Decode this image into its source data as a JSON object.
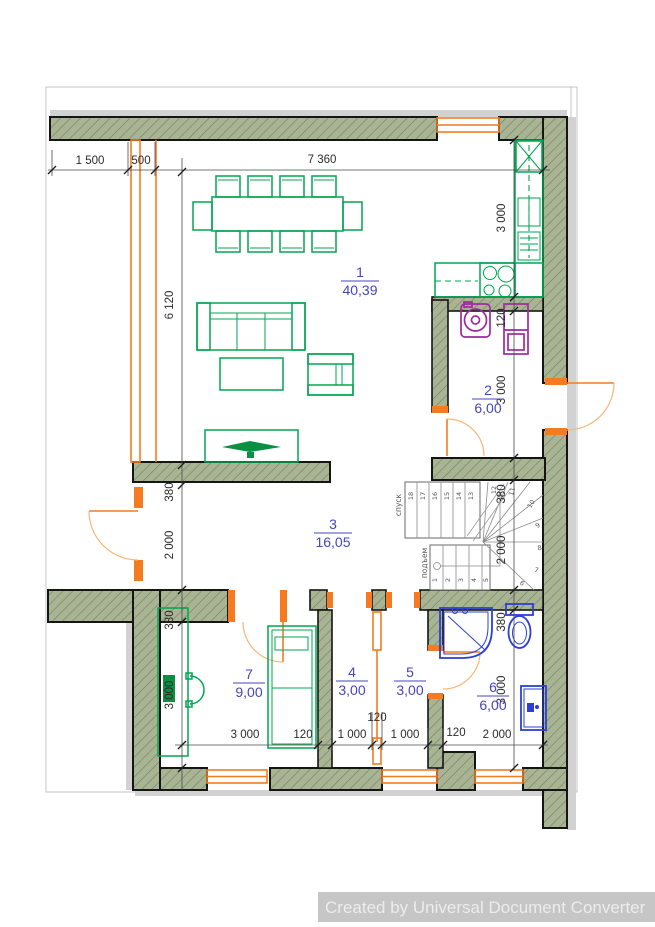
{
  "watermark": {
    "text": "Created by Universal Document Converter"
  },
  "rooms": [
    {
      "number": "1",
      "area": "40,39"
    },
    {
      "number": "2",
      "area": "6,00"
    },
    {
      "number": "3",
      "area": "16,05"
    },
    {
      "number": "4",
      "area": "3,00"
    },
    {
      "number": "5",
      "area": "3,00"
    },
    {
      "number": "6",
      "area": "6,00"
    },
    {
      "number": "7",
      "area": "9,00"
    }
  ],
  "dimensions": {
    "top": [
      "1 500",
      "500",
      "7 360"
    ],
    "left": [
      "6 120",
      "380",
      "2 000",
      "380",
      "3 000"
    ],
    "right": [
      "3 000",
      "120",
      "3 000",
      "380",
      "2 000",
      "380",
      "3 000"
    ],
    "bottom": [
      "3 000",
      "120",
      "1 000",
      "120",
      "1 000",
      "120",
      "2 000"
    ]
  },
  "stairs": {
    "down_label": "спуск",
    "up_label": "подъем",
    "upper_steps": [
      "18",
      "17",
      "16",
      "15",
      "14",
      "13"
    ],
    "lower_steps": [
      "1",
      "2",
      "3",
      "4",
      "5"
    ],
    "winder_steps": [
      "12",
      "11",
      "10",
      "9",
      "8",
      "7",
      "6"
    ]
  },
  "colors": {
    "wall_fill": "#a8b493",
    "furniture": "#00a651",
    "openings": "#f47b20",
    "plumbing": "#2b3fd6",
    "appliance": "#a128a1",
    "room_label": "#4545bb",
    "dimension_text": "#2b2b2b",
    "watermark_bg": "#c6c6c6",
    "watermark_text": "#ececec"
  }
}
